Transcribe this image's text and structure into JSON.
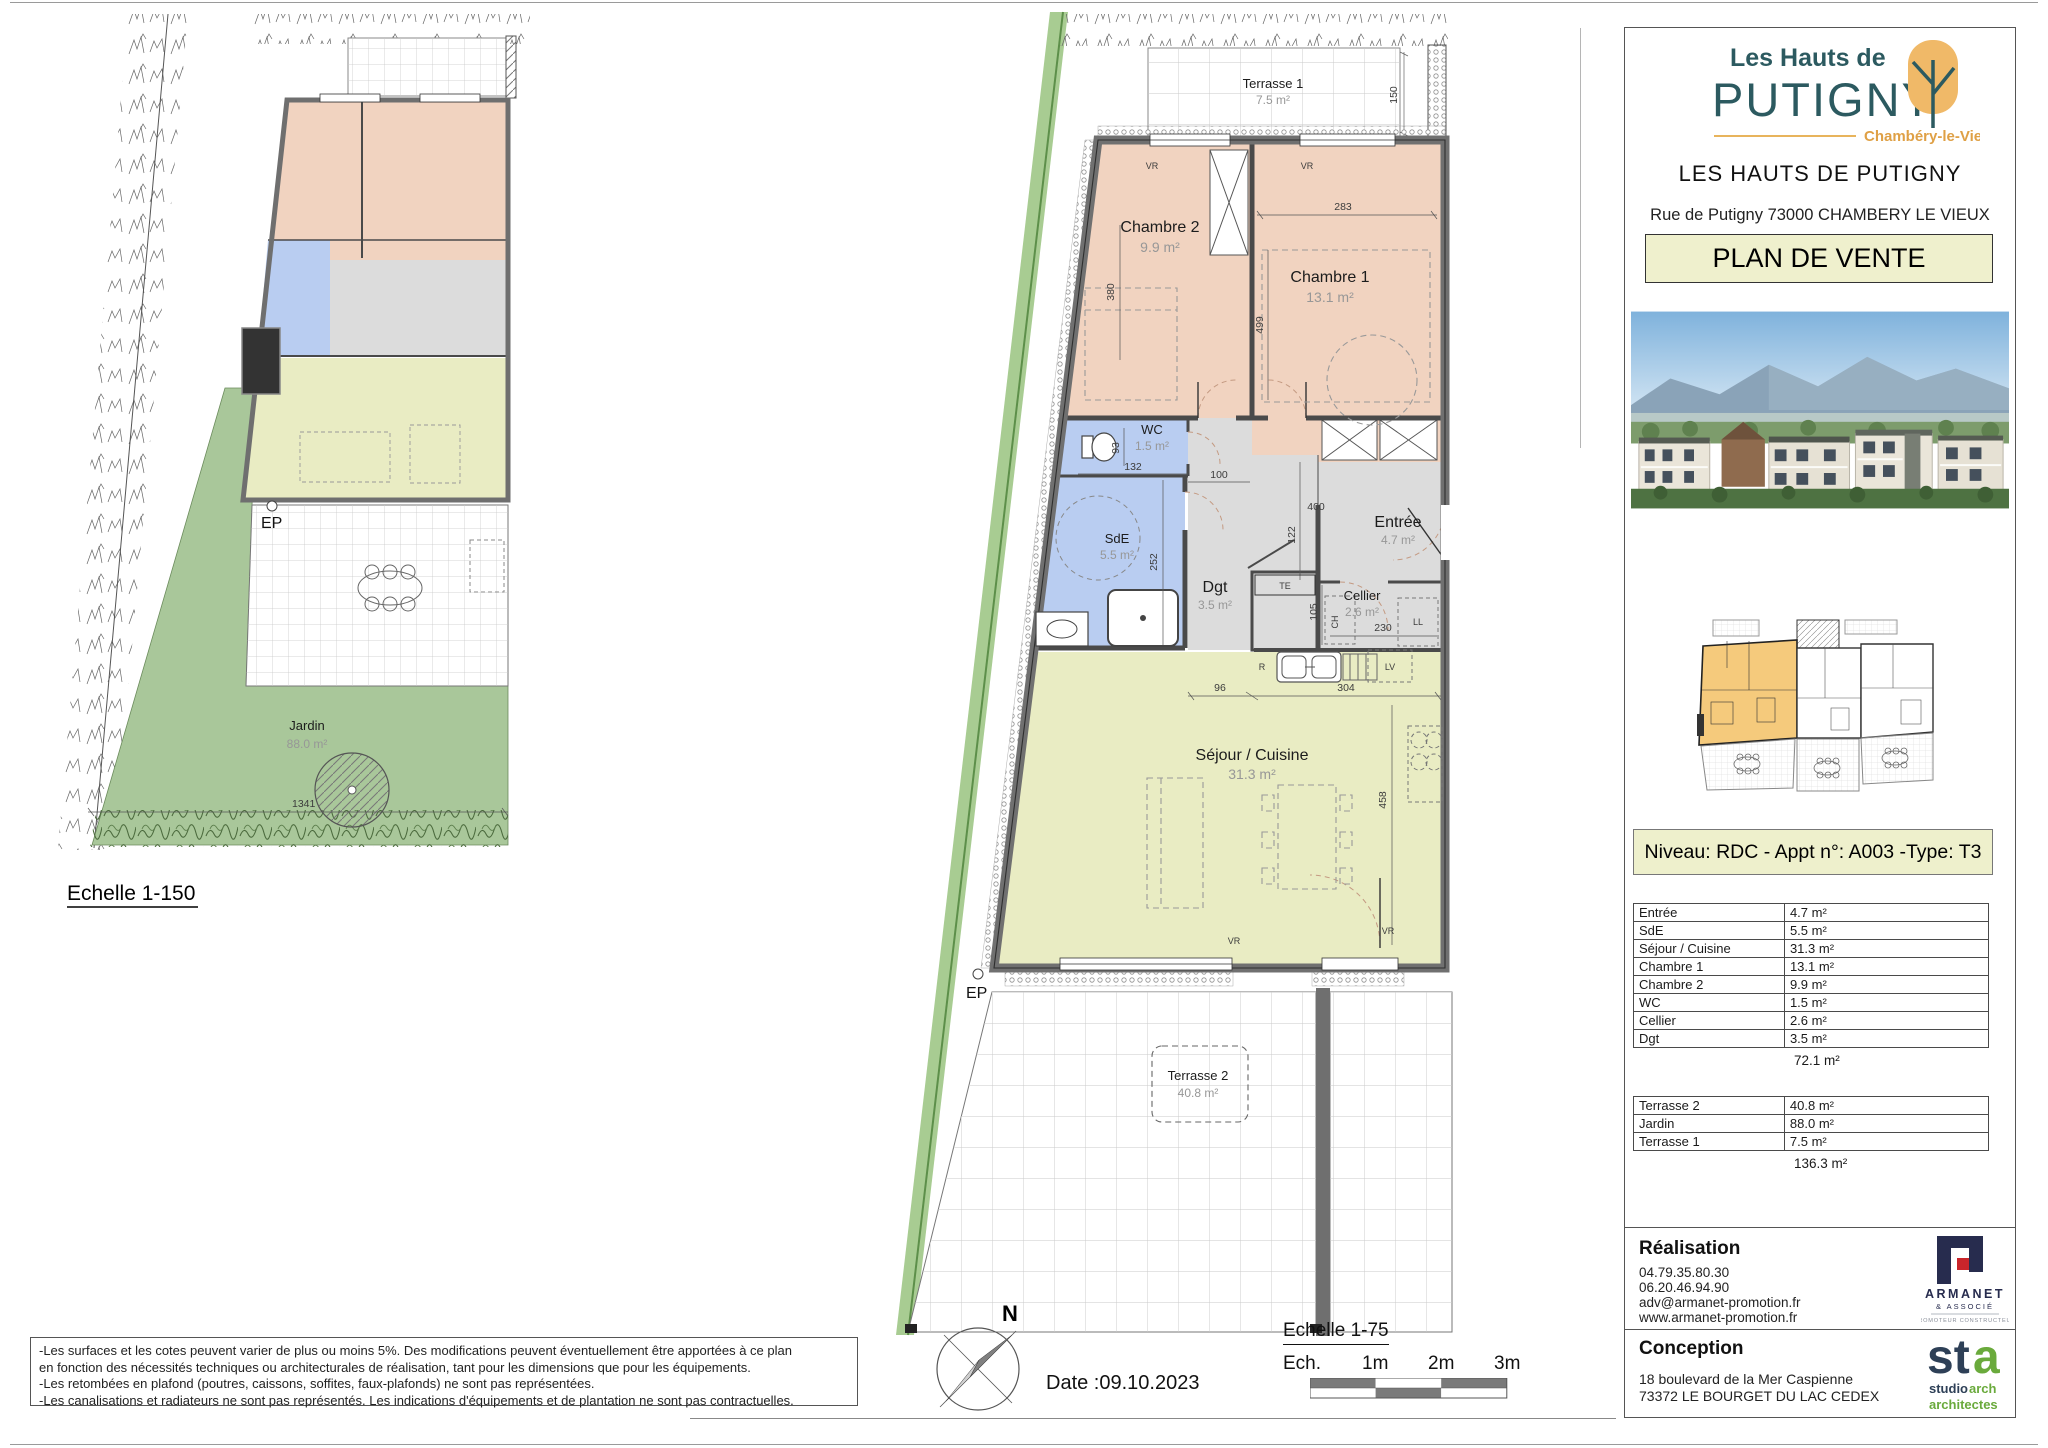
{
  "left_plan": {
    "caption": "Echelle 1-150",
    "ep": "EP",
    "jardin": {
      "name": "Jardin",
      "area": "88.0 m²"
    },
    "dim": "1341"
  },
  "main_plan": {
    "terrasse1": {
      "name": "Terrasse 1",
      "area": "7.5 m²"
    },
    "chambre2": {
      "name": "Chambre 2",
      "area": "9.9 m²"
    },
    "chambre1": {
      "name": "Chambre 1",
      "area": "13.1 m²"
    },
    "wc": {
      "name": "WC",
      "area": "1.5 m²"
    },
    "sde": {
      "name": "SdE",
      "area": "5.5 m²"
    },
    "dgt": {
      "name": "Dgt",
      "area": "3.5 m²"
    },
    "entree": {
      "name": "Entrée",
      "area": "4.7 m²"
    },
    "cellier": {
      "name": "Cellier",
      "area": "2.6 m²"
    },
    "sejour": {
      "name": "Séjour / Cuisine",
      "area": "31.3 m²"
    },
    "terrasse2": {
      "name": "Terrasse 2",
      "area": "40.8 m²"
    },
    "ep": "EP",
    "dims": {
      "d150": "150",
      "d283": "283",
      "d380": "380",
      "d499": "499",
      "d93": "93",
      "d132": "132",
      "d100": "100",
      "d400": "400",
      "d122": "122",
      "d252": "252",
      "d105": "105",
      "d230": "230",
      "d96": "96",
      "d304": "304",
      "d458": "458"
    },
    "tags": {
      "te": "TE",
      "ch": "CH",
      "ll": "LL",
      "lv": "LV",
      "r": "R",
      "vr": "VR"
    }
  },
  "panel": {
    "logo": {
      "line1": "Les Hauts de",
      "line2": "PUTIGNY",
      "line3": "Chambéry-le-Vieux"
    },
    "project_name": "LES HAUTS DE PUTIGNY",
    "address": "Rue de Putigny 73000 CHAMBERY LE VIEUX",
    "doc_title": "PLAN DE VENTE",
    "unit_header": "Niveau: RDC - Appt n°: A003  -Type: T3",
    "areas_table": {
      "rows": [
        [
          "Entrée",
          "4.7 m²"
        ],
        [
          "SdE",
          "5.5 m²"
        ],
        [
          "Séjour / Cuisine",
          "31.3 m²"
        ],
        [
          "Chambre 1",
          "13.1 m²"
        ],
        [
          "Chambre 2",
          "9.9 m²"
        ],
        [
          "WC",
          "1.5 m²"
        ],
        [
          "Cellier",
          "2.6 m²"
        ],
        [
          "Dgt",
          "3.5 m²"
        ]
      ],
      "total": "72.1 m²"
    },
    "outdoor_table": {
      "rows": [
        [
          "Terrasse 2",
          "40.8 m²"
        ],
        [
          "Jardin",
          "88.0 m²"
        ],
        [
          "Terrasse 1",
          "7.5 m²"
        ]
      ],
      "total": "136.3 m²"
    },
    "realisation": {
      "title": "Réalisation",
      "lines": [
        "04.79.35.80.30",
        "06.20.46.94.90",
        "adv@armanet-promotion.fr",
        "www.armanet-promotion.fr"
      ],
      "logo": {
        "name": "ARMANET",
        "sub": "& ASSOCIÉ",
        "tagline": "PROMOTEUR CONSTRUCTEUR"
      }
    },
    "conception": {
      "title": "Conception",
      "lines": [
        "18 boulevard de la Mer Caspienne",
        "73372 LE BOURGET DU LAC CEDEX"
      ],
      "logo": {
        "mark_st": "st",
        "mark_a": "a",
        "line1a": "studio",
        "line1b": " arch",
        "line2": "architectes"
      }
    }
  },
  "footer": {
    "disclaimer": [
      "-Les surfaces et les cotes peuvent varier de plus ou moins 5%. Des modifications peuvent éventuellement être apportées à ce plan",
      "en fonction des nécessités techniques ou architecturales de réalisation, tant pour les dimensions que pour les équipements.",
      "-Les retombées en plafond (poutres, caissons, soffites, faux-plafonds) ne sont pas représentées.",
      "-Les canalisations et radiateurs ne sont pas représentés. Les indications d'équipements et de plantation ne sont pas contractuelles."
    ],
    "compass_n": "N",
    "date": "Date :09.10.2023",
    "scale_title": "Echelle 1-75",
    "scale_labels": [
      "Ech.",
      "1m",
      "2m",
      "3m"
    ]
  }
}
